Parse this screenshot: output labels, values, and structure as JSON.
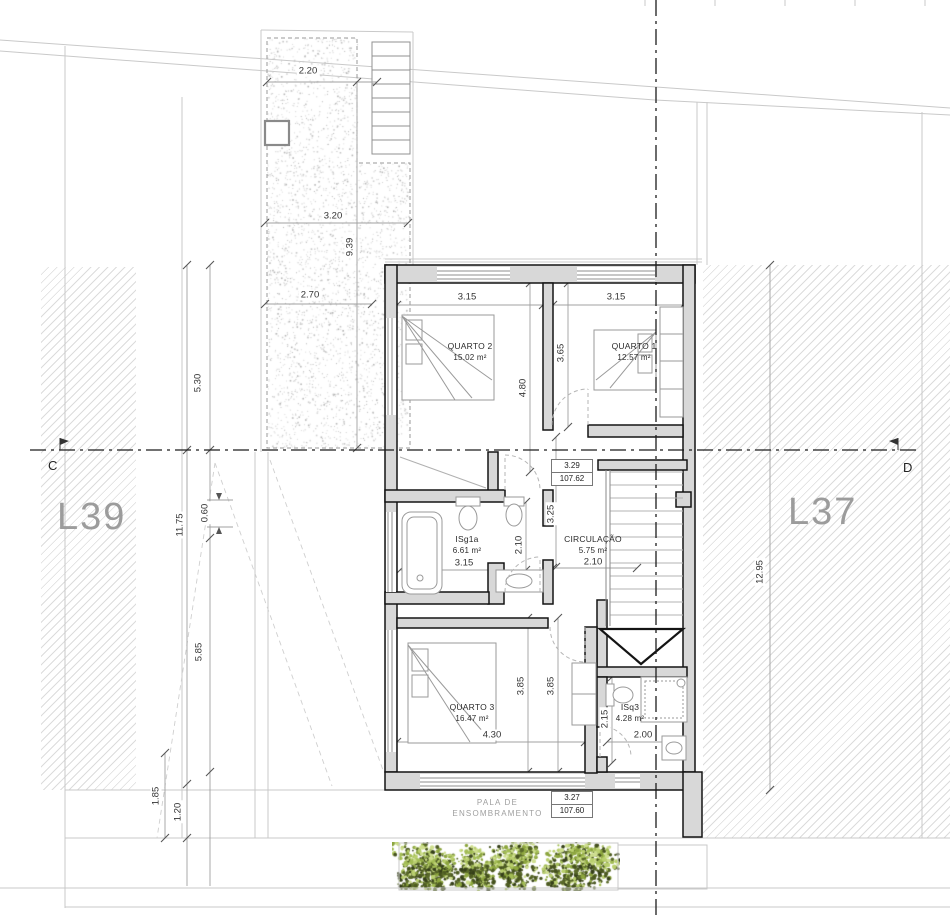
{
  "lots": {
    "left_label": "L39",
    "right_label": "L37"
  },
  "section": {
    "left_marker": "C",
    "right_marker": "D"
  },
  "pala": {
    "line1": "PALA DE",
    "line2": "ENSOMBRAMENTO"
  },
  "rooms": [
    {
      "id": "quarto2",
      "name": "QUARTO 2",
      "area": "15.02 m²",
      "x": 470,
      "y": 341
    },
    {
      "id": "quarto1",
      "name": "QUARTO 1",
      "area": "12.57 m²",
      "x": 634,
      "y": 341
    },
    {
      "id": "isg1a",
      "name": "ISg1a",
      "area": "6.61 m²",
      "x": 467,
      "y": 534
    },
    {
      "id": "circulacao",
      "name": "CIRCULAÇÃO",
      "area": "5.75 m²",
      "x": 593,
      "y": 534
    },
    {
      "id": "quarto3",
      "name": "QUARTO 3",
      "area": "16.47 m²",
      "x": 472,
      "y": 702
    },
    {
      "id": "isq3",
      "name": "ISq3",
      "area": "4.28 m²",
      "x": 630,
      "y": 702
    }
  ],
  "level_markers": [
    {
      "id": "floor-level",
      "top": "3.29",
      "bottom": "107.62",
      "x": 551,
      "y": 459
    },
    {
      "id": "pala-level",
      "top": "3.27",
      "bottom": "107.60",
      "x": 551,
      "y": 791
    }
  ],
  "dimensions": [
    {
      "value": "2.20",
      "x": 308,
      "y": 71,
      "rot": 0
    },
    {
      "value": "3.20",
      "x": 333,
      "y": 216,
      "rot": 0
    },
    {
      "value": "9.39",
      "x": 350,
      "y": 247,
      "rot": 90
    },
    {
      "value": "2.70",
      "x": 310,
      "y": 295,
      "rot": 0
    },
    {
      "value": "5.30",
      "x": 198,
      "y": 383,
      "rot": 90
    },
    {
      "value": "11.75",
      "x": 180,
      "y": 525,
      "rot": 90
    },
    {
      "value": "0.60",
      "x": 205,
      "y": 513,
      "rot": 90
    },
    {
      "value": "5.85",
      "x": 199,
      "y": 652,
      "rot": 90
    },
    {
      "value": "1.85",
      "x": 156,
      "y": 796,
      "rot": 90
    },
    {
      "value": "1.20",
      "x": 178,
      "y": 812,
      "rot": 90
    },
    {
      "value": "3.15",
      "x": 467,
      "y": 297,
      "rot": 0
    },
    {
      "value": "3.15",
      "x": 616,
      "y": 297,
      "rot": 0
    },
    {
      "value": "4.80",
      "x": 523,
      "y": 388,
      "rot": 90
    },
    {
      "value": "3.65",
      "x": 561,
      "y": 353,
      "rot": 90
    },
    {
      "value": "3.25",
      "x": 551,
      "y": 514,
      "rot": 90
    },
    {
      "value": "2.10",
      "x": 519,
      "y": 545,
      "rot": 90
    },
    {
      "value": "3.15",
      "x": 464,
      "y": 563,
      "rot": 0
    },
    {
      "value": "2.10",
      "x": 593,
      "y": 562,
      "rot": 0
    },
    {
      "value": "3.85",
      "x": 521,
      "y": 686,
      "rot": 90
    },
    {
      "value": "3.85",
      "x": 551,
      "y": 686,
      "rot": 90
    },
    {
      "value": "4.30",
      "x": 492,
      "y": 735,
      "rot": 0
    },
    {
      "value": "2.15",
      "x": 605,
      "y": 719,
      "rot": 90
    },
    {
      "value": "2.00",
      "x": 643,
      "y": 735,
      "rot": 0
    },
    {
      "value": "12.95",
      "x": 760,
      "y": 572,
      "rot": 90
    }
  ]
}
